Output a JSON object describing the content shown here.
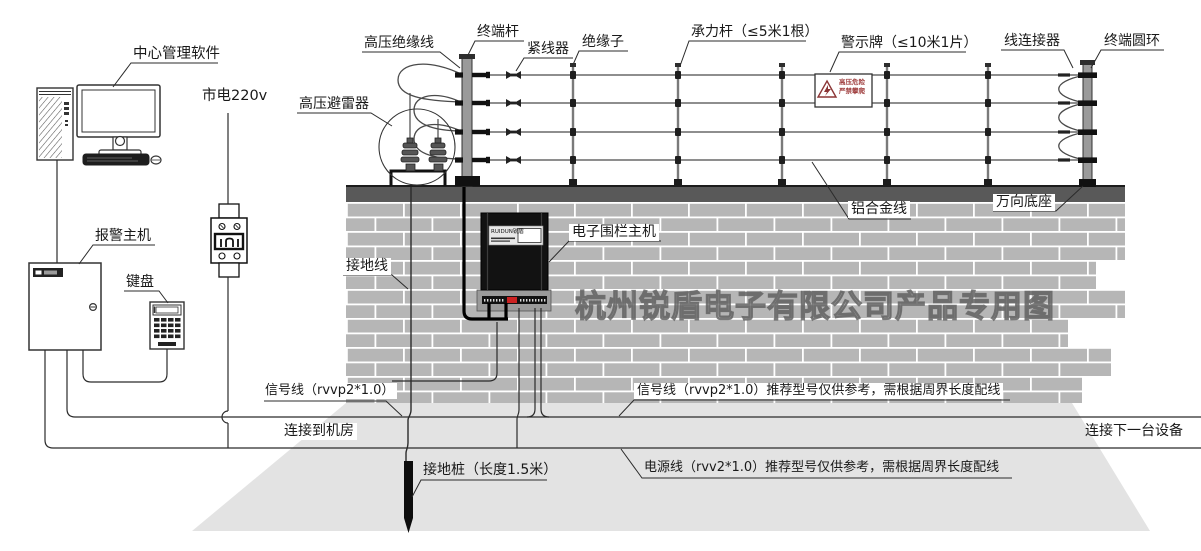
{
  "diagram": {
    "watermark": "杭州锐盾电子有限公司产品专用图",
    "labels": {
      "center_software": "中心管理软件",
      "mains_power": "市电220v",
      "arrester": "高压避雷器",
      "alarm_host": "报警主机",
      "keypad": "键盘",
      "hv_insulated_wire": "高压绝缘线",
      "terminal_pole": "终端杆",
      "tensioner": "紧线器",
      "insulator": "绝缘子",
      "load_pole": "承力杆（≤5米1根）",
      "warning_sign": "警示牌（≤10米1片）",
      "wire_connector": "线连接器",
      "terminal_ring": "终端圆环",
      "aluminum_wire": "铝合金线",
      "universal_base": "万向底座",
      "fence_host": "电子围栏主机",
      "ground_wire": "接地线",
      "signal_wire_left": "信号线（rvvp2*1.0）",
      "to_machine_room": "连接到机房",
      "signal_wire_right": "信号线（rvvp2*1.0）推荐型号仅供参考，需根据周界长度配线",
      "to_next_device": "连接下一台设备",
      "power_wire": "电源线（rvv2*1.0）推荐型号仅供参考，需根据周界长度配线",
      "ground_stake": "接地桩（长度1.5米）"
    },
    "fence_host_device": {
      "logo": "RUIDUN锐盾"
    },
    "warning_sign_text": {
      "line1": "高压危险",
      "line2": "严禁攀爬"
    },
    "colors": {
      "brick": "#b6b6b6",
      "mortar": "#ffffff",
      "wall_cap": "#595959",
      "ground": "#e3e3e3",
      "line": "#2b2b2b",
      "warning_text": "#a04040"
    }
  }
}
